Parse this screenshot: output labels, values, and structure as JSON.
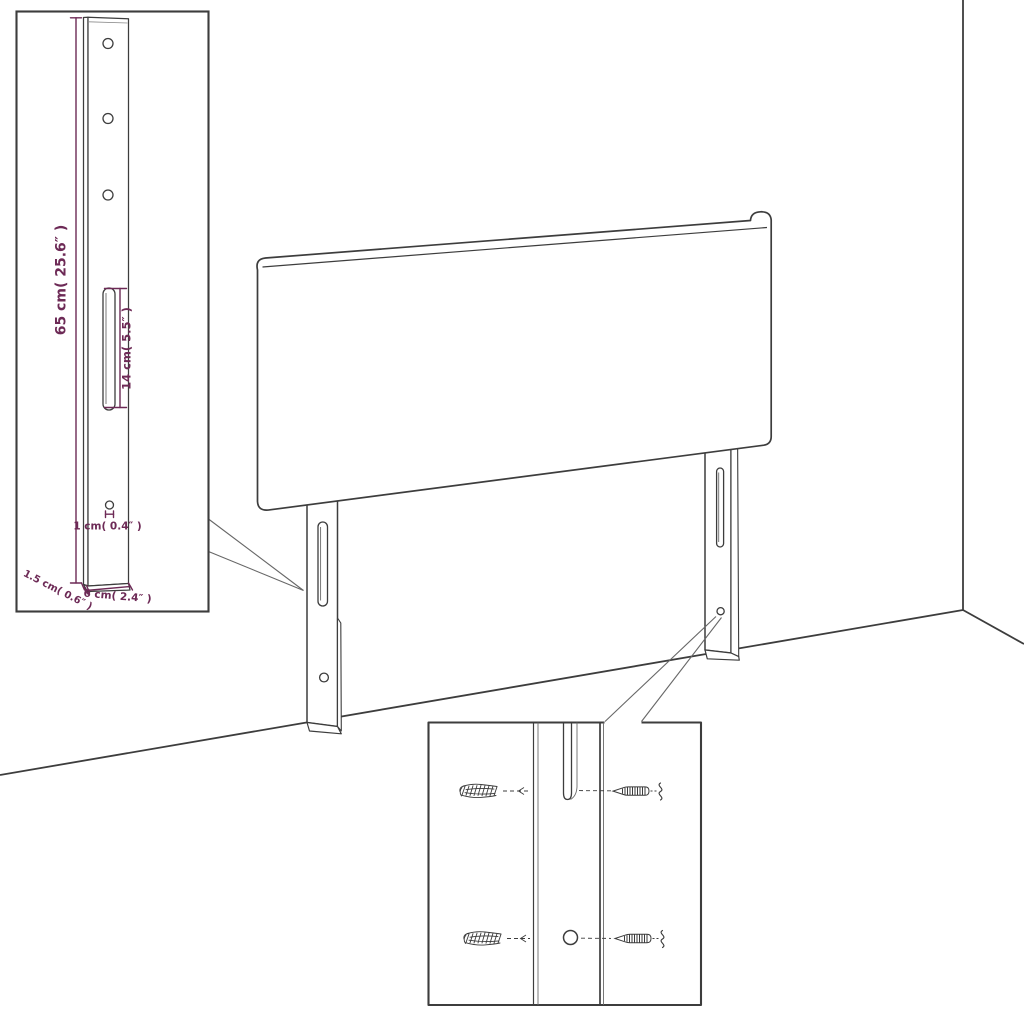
{
  "diagram": {
    "kind": "headboard wall-mounting assembly line drawing",
    "colors": {
      "line": "#3d3d3d",
      "secondary_line": "#6a6a6a",
      "dimension": "#6d2a56",
      "background": "#ffffff"
    },
    "leg_detail": {
      "height_label": "65 cm( 25.6″ )",
      "slot_label": "14 cm( 5.5″ )",
      "hole_label": "1 cm( 0.4″ )",
      "depth_label": "1.5 cm( 0.6″ )",
      "width_label": "6 cm( 2.4″ )"
    }
  }
}
